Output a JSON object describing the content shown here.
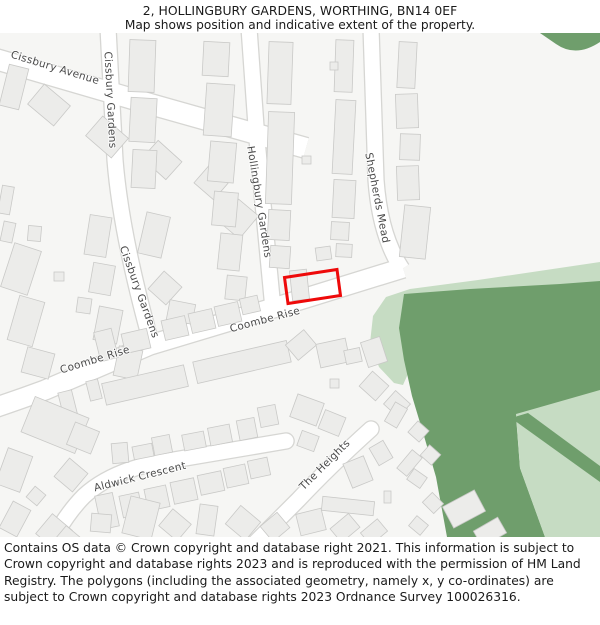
{
  "header": {
    "title": "2, HOLLINGBURY GARDENS, WORTHING, BN14 0EF",
    "subtitle": "Map shows position and indicative extent of the property."
  },
  "footer": {
    "attribution": "Contains OS data © Crown copyright and database right 2021. This information is subject to Crown copyright and database rights 2023 and is reproduced with the permission of HM Land Registry. The polygons (including the associated geometry, namely x, y co-ordinates) are subject to Crown copyright and database rights 2023 Ordnance Survey 100026316."
  },
  "map": {
    "colors": {
      "map_bg": "#f6f6f4",
      "road_fill": "#ffffff",
      "road_edge": "#d6d6d3",
      "building": "#ececea",
      "building_edge": "#c9c9c7",
      "green_dark": "#6f9e6c",
      "green_light": "#c6dcc3",
      "property_outline": "#ee0a0a",
      "label": "#4a4a4a"
    },
    "green_areas": [
      {
        "name": "green-light-band-and-finger",
        "shade": "light",
        "d": "M 600 262 L 478 280 L 410 289 L 386 297 L 373 316 L 370 343 L 379 367 L 394 383 L 403 385 L 411 367 L 403 342 L 401 317 L 412 301 L 455 296 L 540 290 L 600 284 Z"
      },
      {
        "name": "green-dark-main",
        "shade": "dark",
        "d": "M 404 294 L 470 289 L 560 284 L 600 281 L 600 391 L 516 416 L 520 468 L 545 537 L 447 537 L 436 477 L 424 436 L 412 396 L 404 360 L 399 328 Z"
      },
      {
        "name": "green-light-se-wedge",
        "shade": "light",
        "d": "M 516 414 L 600 390 L 600 537 L 545 537 L 520 468 Z"
      },
      {
        "name": "green-dark-strip",
        "shade": "dark",
        "d": "M 511 418 L 528 413 L 600 466 L 600 482 Z"
      },
      {
        "name": "green-dark-top-right",
        "shade": "dark",
        "d": "M 540 33 L 600 33 L 600 42 Q 576 58 556 44 Z"
      }
    ],
    "roads": [
      {
        "name": "cissbury-avenue",
        "d": "M -8 58 L 150 104 L 306 148",
        "w": 20
      },
      {
        "name": "cissbury-gardens",
        "d": "M 108 28 L 115 160 Q 121 235 152 346",
        "w": 15
      },
      {
        "name": "hollingbury-gardens",
        "d": "M 249 28 L 257 140 L 273 309",
        "w": 15
      },
      {
        "name": "shepherds-mead",
        "d": "M 371 28 L 376 180 Q 380 236 402 269",
        "w": 15
      },
      {
        "name": "coombe-rise",
        "d": "M -12 410 Q 18 400 45 390 L 150 345 L 280 306 L 403 268",
        "w": 19
      },
      {
        "name": "aldwick-crescent",
        "d": "M 42 560 Q 62 518 84 496 Q 108 474 150 464 L 286 441",
        "w": 15,
        "cap": "round"
      },
      {
        "name": "the-heights",
        "d": "M 250 548 L 298 500 Q 330 466 371 429",
        "w": 15,
        "cap": "round"
      }
    ],
    "street_labels": [
      {
        "text": "Cissbury Avenue",
        "x": 55,
        "y": 68,
        "r": 17
      },
      {
        "text": "Cissbury Gardens",
        "x": 110,
        "y": 100,
        "r": 87
      },
      {
        "text": "Cissbury Gardens",
        "x": 139,
        "y": 292,
        "r": 70
      },
      {
        "text": "Hollingbury Gardens",
        "x": 259,
        "y": 202,
        "r": 81
      },
      {
        "text": "Shepherds Mead",
        "x": 377,
        "y": 198,
        "r": 79
      },
      {
        "text": "Coombe Rise",
        "x": 95,
        "y": 360,
        "r": -17
      },
      {
        "text": "Coombe Rise",
        "x": 265,
        "y": 320,
        "r": -15
      },
      {
        "text": "Aldwick Crescent",
        "x": 140,
        "y": 477,
        "r": -14
      },
      {
        "text": "The Heights",
        "x": 325,
        "y": 465,
        "r": -45
      }
    ],
    "property": {
      "label": "2 Hollingbury Gardens indicative extent",
      "points": "284.5,277.5 337,269.5 340.5,295.5 288,303.5"
    },
    "buildings": [
      [
        4,
        66,
        20,
        42,
        14
      ],
      [
        32,
        92,
        34,
        26,
        40
      ],
      [
        90,
        124,
        34,
        26,
        41
      ],
      [
        146,
        148,
        32,
        24,
        42
      ],
      [
        198,
        172,
        26,
        22,
        41
      ],
      [
        226,
        204,
        26,
        30,
        40
      ],
      [
        28,
        226,
        13,
        15,
        5
      ],
      [
        129,
        40,
        26,
        52,
        2
      ],
      [
        130,
        98,
        26,
        44,
        3
      ],
      [
        132,
        150,
        24,
        38,
        3
      ],
      [
        203,
        42,
        26,
        34,
        3
      ],
      [
        205,
        84,
        28,
        52,
        4
      ],
      [
        209,
        142,
        26,
        40,
        5
      ],
      [
        213,
        192,
        24,
        34,
        5
      ],
      [
        219,
        234,
        22,
        36,
        6
      ],
      [
        226,
        276,
        20,
        24,
        6
      ],
      [
        268,
        42,
        24,
        62,
        2
      ],
      [
        267,
        112,
        26,
        92,
        2
      ],
      [
        268,
        210,
        22,
        30,
        3
      ],
      [
        270,
        246,
        20,
        22,
        4
      ],
      [
        291,
        270,
        17,
        30,
        -6
      ],
      [
        302,
        156,
        9,
        8,
        0
      ],
      [
        335,
        40,
        18,
        52,
        2
      ],
      [
        334,
        100,
        20,
        74,
        3
      ],
      [
        333,
        180,
        22,
        38,
        3
      ],
      [
        331,
        222,
        18,
        18,
        3
      ],
      [
        336,
        244,
        16,
        13,
        3
      ],
      [
        316,
        247,
        15,
        13,
        -8
      ],
      [
        330,
        62,
        8,
        8,
        0
      ],
      [
        398,
        42,
        18,
        46,
        3
      ],
      [
        396,
        94,
        22,
        34,
        -2
      ],
      [
        400,
        134,
        20,
        26,
        2
      ],
      [
        397,
        166,
        22,
        34,
        -2
      ],
      [
        402,
        206,
        26,
        52,
        6
      ],
      [
        142,
        214,
        24,
        42,
        13
      ],
      [
        153,
        276,
        24,
        24,
        42
      ],
      [
        168,
        302,
        26,
        20,
        11
      ],
      [
        87,
        216,
        22,
        40,
        9
      ],
      [
        91,
        264,
        22,
        30,
        10
      ],
      [
        77,
        298,
        14,
        15,
        8
      ],
      [
        96,
        308,
        24,
        34,
        11
      ],
      [
        116,
        348,
        24,
        30,
        12
      ],
      [
        54,
        272,
        10,
        9,
        0
      ],
      [
        0,
        186,
        12,
        28,
        10
      ],
      [
        2,
        222,
        12,
        20,
        12
      ],
      [
        7,
        246,
        28,
        46,
        18
      ],
      [
        13,
        298,
        26,
        46,
        16
      ],
      [
        24,
        350,
        28,
        26,
        15
      ],
      [
        97,
        330,
        18,
        30,
        -14
      ],
      [
        123,
        331,
        26,
        20,
        -13
      ],
      [
        163,
        318,
        24,
        20,
        -13
      ],
      [
        190,
        311,
        24,
        20,
        -13
      ],
      [
        216,
        304,
        24,
        20,
        -13
      ],
      [
        241,
        297,
        18,
        16,
        -13
      ],
      [
        61,
        391,
        14,
        28,
        -14
      ],
      [
        88,
        380,
        12,
        20,
        -14
      ],
      [
        103,
        374,
        84,
        22,
        -13
      ],
      [
        194,
        351,
        96,
        22,
        -13
      ],
      [
        289,
        335,
        24,
        20,
        -40
      ],
      [
        318,
        341,
        30,
        24,
        -12
      ],
      [
        345,
        349,
        16,
        14,
        -12
      ],
      [
        364,
        339,
        20,
        26,
        -18
      ],
      [
        293,
        398,
        28,
        24,
        20
      ],
      [
        321,
        413,
        22,
        20,
        22
      ],
      [
        299,
        433,
        18,
        16,
        20
      ],
      [
        330,
        379,
        9,
        9,
        0
      ],
      [
        363,
        376,
        22,
        20,
        42
      ],
      [
        387,
        395,
        20,
        18,
        42
      ],
      [
        26,
        406,
        58,
        38,
        22
      ],
      [
        70,
        426,
        26,
        24,
        22
      ],
      [
        112,
        443,
        16,
        20,
        -5
      ],
      [
        133,
        445,
        20,
        13,
        -11
      ],
      [
        153,
        436,
        18,
        18,
        -11
      ],
      [
        183,
        433,
        22,
        16,
        -11
      ],
      [
        209,
        426,
        22,
        18,
        -11
      ],
      [
        238,
        419,
        18,
        20,
        -11
      ],
      [
        259,
        406,
        18,
        20,
        -11
      ],
      [
        59,
        463,
        24,
        24,
        40
      ],
      [
        98,
        494,
        18,
        34,
        -12
      ],
      [
        121,
        494,
        20,
        22,
        -12
      ],
      [
        146,
        487,
        22,
        22,
        -12
      ],
      [
        172,
        480,
        24,
        22,
        -12
      ],
      [
        199,
        473,
        24,
        20,
        -12
      ],
      [
        225,
        466,
        22,
        20,
        -12
      ],
      [
        249,
        459,
        20,
        18,
        -12
      ],
      [
        1,
        451,
        26,
        38,
        20
      ],
      [
        29,
        489,
        14,
        14,
        40
      ],
      [
        5,
        504,
        20,
        30,
        28
      ],
      [
        41,
        519,
        26,
        26,
        40
      ],
      [
        57,
        531,
        24,
        20,
        40
      ],
      [
        91,
        514,
        20,
        18,
        5
      ],
      [
        126,
        499,
        30,
        38,
        14
      ],
      [
        163,
        514,
        24,
        22,
        40
      ],
      [
        198,
        505,
        18,
        30,
        8
      ],
      [
        230,
        511,
        26,
        24,
        40
      ],
      [
        264,
        517,
        22,
        20,
        -40
      ],
      [
        298,
        511,
        26,
        22,
        -14
      ],
      [
        333,
        519,
        24,
        18,
        -40
      ],
      [
        363,
        524,
        22,
        16,
        -40
      ],
      [
        347,
        459,
        22,
        26,
        -22
      ],
      [
        373,
        443,
        16,
        20,
        -30
      ],
      [
        403,
        451,
        13,
        24,
        40
      ],
      [
        322,
        499,
        52,
        14,
        6
      ],
      [
        384,
        491,
        7,
        12,
        0
      ],
      [
        411,
        424,
        15,
        15,
        42
      ],
      [
        423,
        448,
        15,
        14,
        42
      ],
      [
        409,
        472,
        16,
        13,
        35
      ],
      [
        425,
        496,
        16,
        14,
        45
      ],
      [
        411,
        519,
        15,
        13,
        40
      ],
      [
        389,
        404,
        14,
        22,
        30
      ],
      [
        446,
        497,
        36,
        24,
        -28
      ],
      [
        476,
        523,
        28,
        18,
        -30
      ]
    ]
  }
}
